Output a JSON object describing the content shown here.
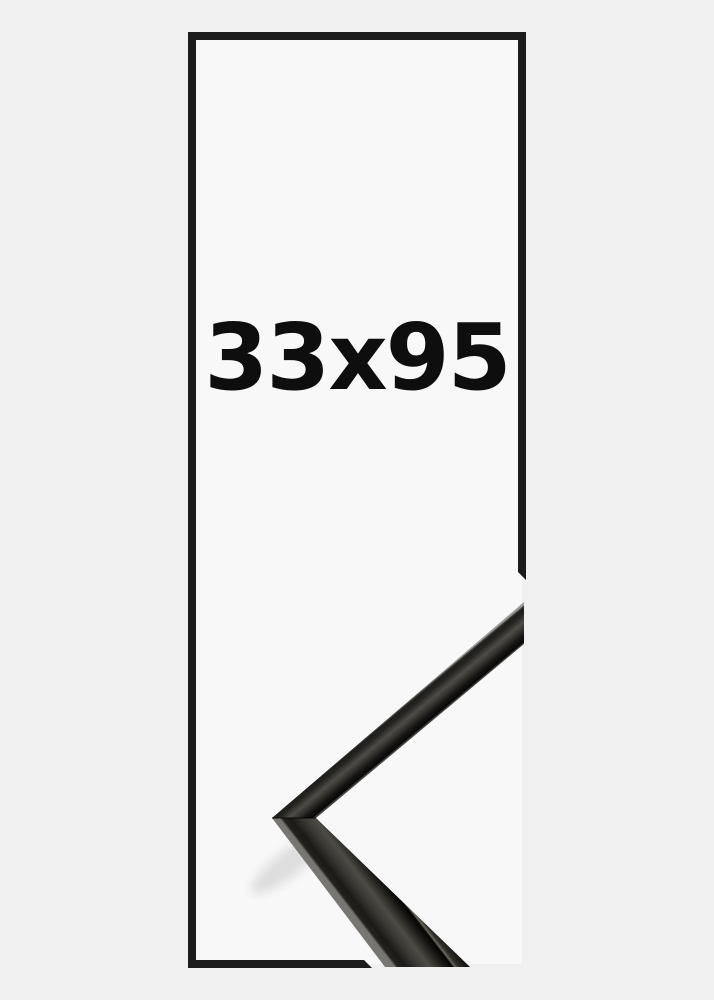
{
  "page": {
    "background_color": "#f0f0f1"
  },
  "frame_diagram": {
    "size_label": "33x95",
    "outline_color": "#1c1c1c",
    "interior_color": "#f8f8f8",
    "label_color": "#0e0e0e"
  },
  "corner_sample": {
    "description": "black metal picture-frame corner moulding sample",
    "base_color": "#141312",
    "highlight_color": "#4d4b45",
    "side_face_color": "#2e2c28"
  }
}
